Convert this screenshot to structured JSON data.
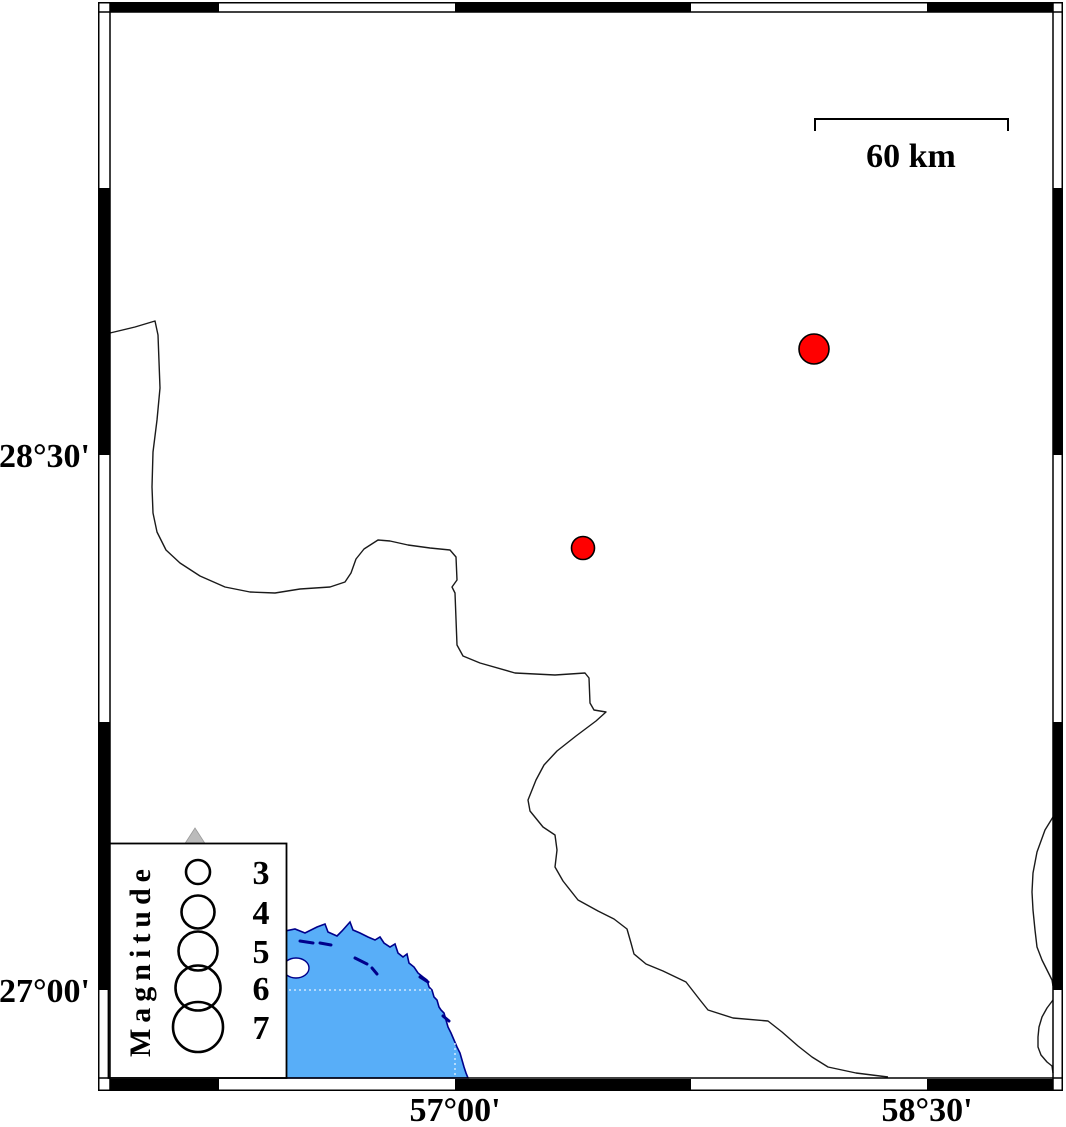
{
  "map_frame": {
    "left_axis_labels": [
      {
        "text": "28°30'"
      },
      {
        "text": "27°00'"
      }
    ],
    "bottom_axis_labels": [
      {
        "text": "57°00'"
      },
      {
        "text": "58°30'"
      }
    ]
  },
  "scale_bar": {
    "label": "60 km"
  },
  "legend": {
    "title": "Magnitude",
    "entries": [
      {
        "magnitude": "3",
        "radius": 12,
        "cy": 872
      },
      {
        "magnitude": "4",
        "radius": 16.5,
        "cy": 912
      },
      {
        "magnitude": "5",
        "radius": 19.5,
        "cy": 951
      },
      {
        "magnitude": "6",
        "radius": 22.5,
        "cy": 988
      },
      {
        "magnitude": "7",
        "radius": 25,
        "cy": 1027
      }
    ]
  },
  "earthquakes": [
    {
      "cx": 814,
      "cy": 349,
      "r": 15
    },
    {
      "cx": 583,
      "cy": 548,
      "r": 11.5
    }
  ],
  "colors": {
    "sea": "#58AEF8",
    "sea_outline": "#00008B",
    "earthquake_fill": "#FF0000",
    "outline": "#000000",
    "station_triangle": "#BBBBBB"
  }
}
